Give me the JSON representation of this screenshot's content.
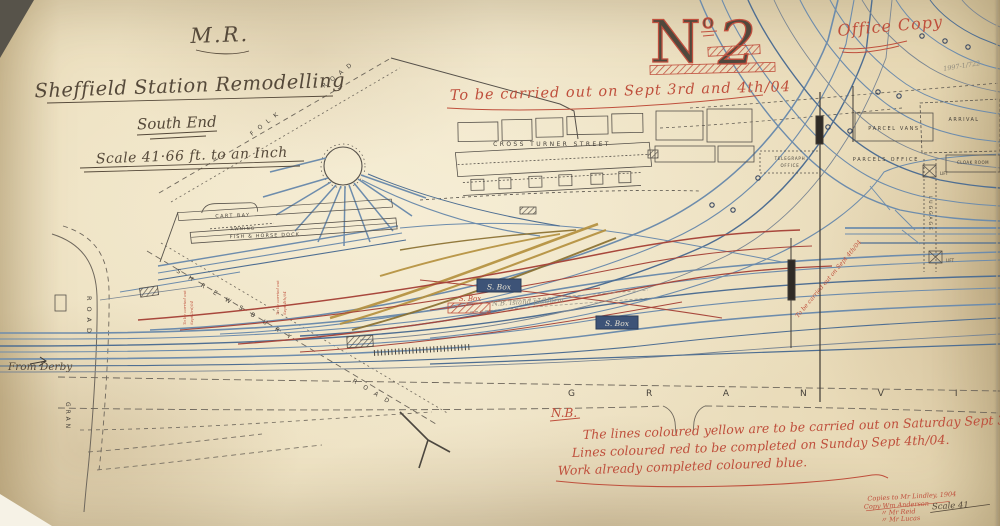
{
  "paper": {
    "background": "#e9dcbb",
    "ink": "#50483c",
    "red": "#bf4f3c",
    "blue": "#6d8cac",
    "blue_dark": "#4e6e92",
    "yellow": "#b5913f",
    "pencil": "#8f8a7d"
  },
  "title_block": {
    "railway": "M.R.",
    "title": "Sheffield Station Remodelling",
    "subtitle": "South End",
    "scale": "Scale 41·66 ft. to an Inch"
  },
  "header_notes": {
    "carry_out": "To be carried out on Sept 3rd and 4th/04",
    "sheet_number_prefix": "N",
    "sheet_number_sup": "o",
    "sheet_number": "2",
    "office_copy": "Office Copy",
    "pencil_ref": "1997-1/722"
  },
  "nb_note": {
    "heading": "N.B.",
    "lines": [
      "The lines coloured yellow are to be carried out on Saturday Sept 3rd/04",
      "Lines coloured red to be completed on Sunday Sept 4th/04.",
      "Work already completed coloured blue."
    ]
  },
  "signature_block": {
    "lines": [
      "Copies to Mr Lindley, 1904",
      "Copy Wm Anderson",
      "〃  Mr Reid",
      "〃  Mr Lucas"
    ],
    "scale_fragment": "Scale 41"
  },
  "map_labels": {
    "cross_turner_street": "CROSS TURNER STREET",
    "cart_bay": "CART BAY",
    "awning": "AWNING",
    "fish_horse_dock": "FISH & HORSE DOCK",
    "parcel_vans": "PARCEL VANS",
    "arrival": "ARRIVAL",
    "parcels_office": "PARCELS OFFICE",
    "telegraph_line1": "TELEGRAPH",
    "telegraph_line2": "OFFICE",
    "cloak_room": "CLOAK ROOM",
    "lift": "LIFT",
    "luggage": "LUGGAGE",
    "signal_box": "S. Box",
    "norfolk_part1": "FOLK",
    "norfolk_part2": "ROAD",
    "shrewsbury": "SHREWSBURY",
    "shrewsbury_road": "ROAD",
    "road_left": "ROAD",
    "gran_left": "GRAN",
    "granville_letters": "GRANVI",
    "from_derby": "From Derby",
    "island_platform": "N.B. Island platform"
  },
  "red_notes": {
    "vertical_a_1": "To be carried out",
    "vertical_a_2": "Sept 3rd/04",
    "vertical_b_1": "To be carried out",
    "vertical_b_2": "Sept 4th/04",
    "diagonal": "To be carried out on Sept 4th/04"
  }
}
